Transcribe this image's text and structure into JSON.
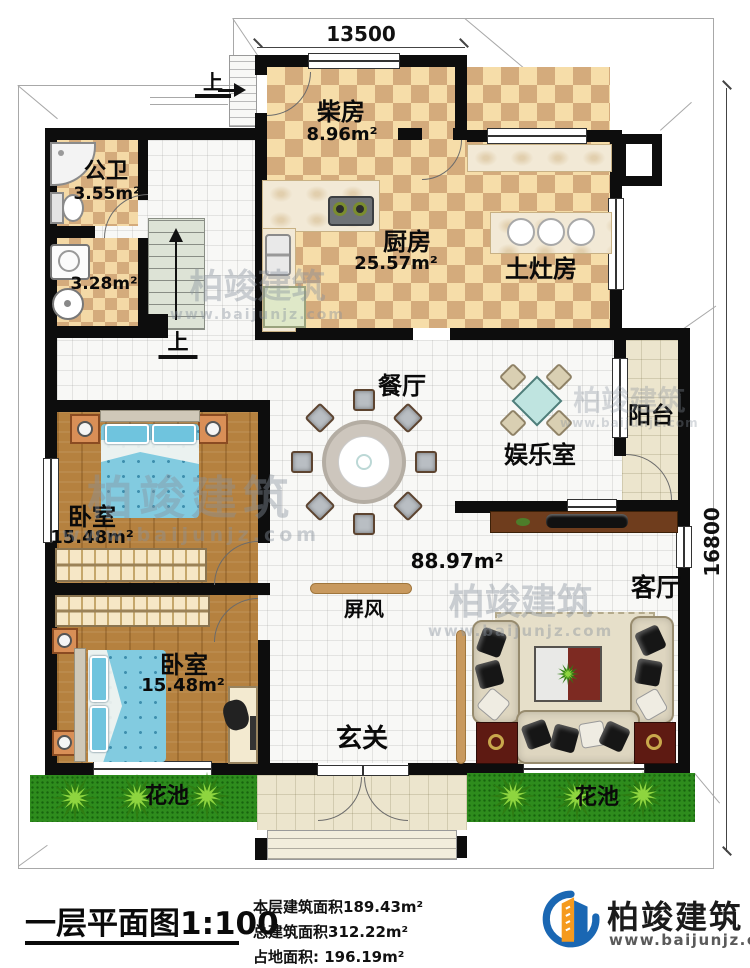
{
  "dims": {
    "width": "13500",
    "height": "16800"
  },
  "stairs": {
    "up": "上"
  },
  "entry": {
    "up": "上"
  },
  "rooms": {
    "firewood": {
      "name": "柴房",
      "area": "8.96m²"
    },
    "bathroom": {
      "name": "公卫",
      "area": "3.55m²"
    },
    "laundry": {
      "area": "3.28m²"
    },
    "kitchen": {
      "name": "厨房",
      "area": "25.57m²"
    },
    "stove_room": {
      "name": "土灶房"
    },
    "dining": {
      "name": "餐厅"
    },
    "game_room": {
      "name": "娱乐室"
    },
    "balcony": {
      "name": "阳台"
    },
    "bedroom_top": {
      "name": "卧室",
      "area": "15.48m²"
    },
    "bedroom_bottom": {
      "name": "卧室",
      "area": "15.48m²"
    },
    "living": {
      "name": "客厅",
      "area": "88.97m²"
    },
    "foyer": {
      "name": "玄关"
    },
    "screen": {
      "name": "屏风"
    },
    "flowerbed_left": {
      "name": "花池"
    },
    "flowerbed_right": {
      "name": "花池"
    }
  },
  "title_block": {
    "title": "一层平面图1:100",
    "stats": [
      "本层建筑面积189.43m²",
      "总建筑面积312.22m²",
      "占地面积: 196.19m²"
    ]
  },
  "brand": {
    "name": "柏竣建筑",
    "url": "www.baijunjz.com"
  },
  "watermark": {
    "text": "柏竣建筑",
    "url": "www.baijunjz.com"
  },
  "colors": {
    "wall": "#0d0d0d",
    "tile_dark": "#d4ab7c",
    "tile_light": "#f6dda9",
    "wood": "#b5813f",
    "grass": "#2e8c1d",
    "bed_blue": "#82cbe0",
    "accent_red": "#5e1a12",
    "logo_blue": "#1a67b3",
    "logo_orange": "#f59a1e"
  }
}
